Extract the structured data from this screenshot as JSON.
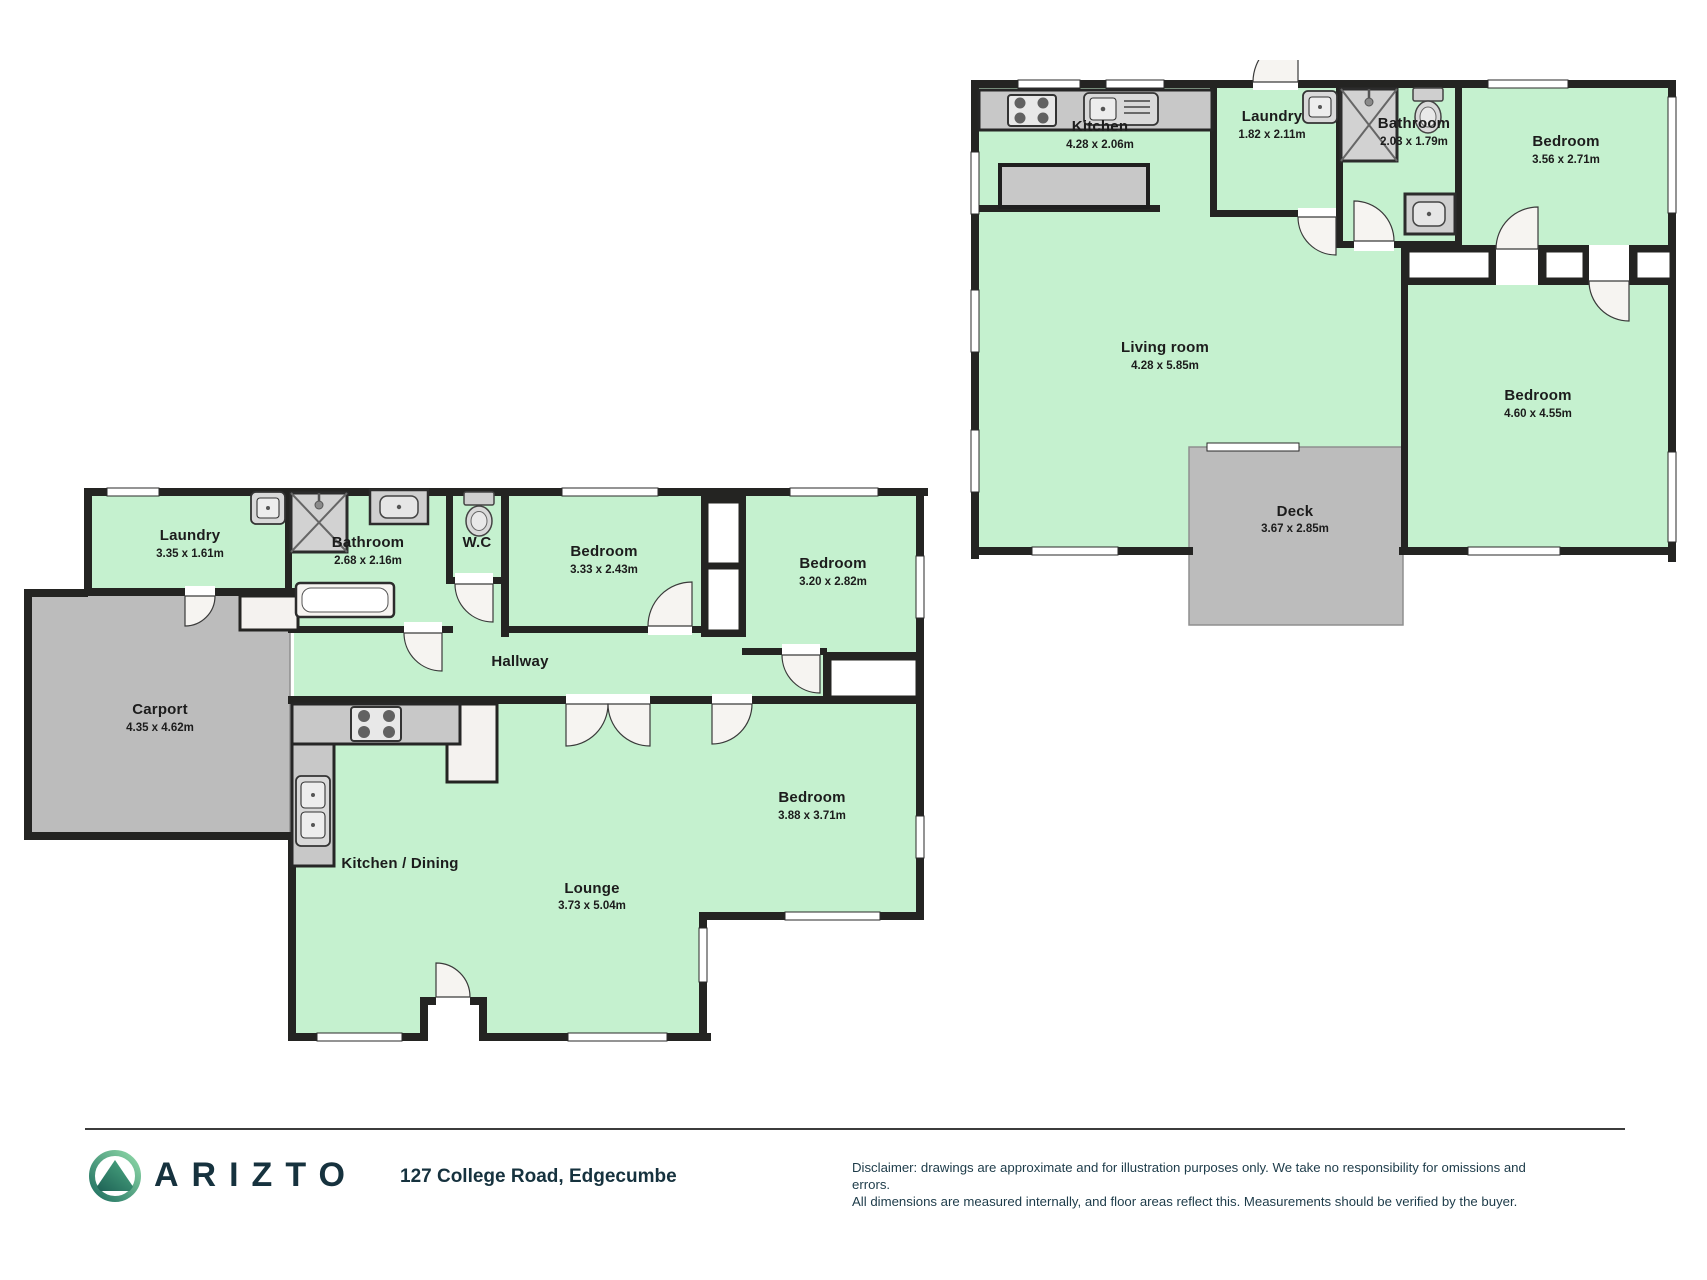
{
  "colors": {
    "floor_green": "#c5f1cf",
    "wall_black": "#242422",
    "outdoor_gray": "#bcbcbc",
    "brand_navy": "#16323e",
    "logo_green_light": "#8fd9a8",
    "logo_teal_dark": "#1e6f60"
  },
  "plans": {
    "upper": {
      "kitchen": {
        "label": "Kitchen",
        "dims": "4.28 x 2.06m"
      },
      "laundry": {
        "label": "Laundry",
        "dims": "1.82 x 2.11m"
      },
      "bathroom": {
        "label": "Bathroom",
        "dims": "2.03 x 1.79m"
      },
      "bedroom1": {
        "label": "Bedroom",
        "dims": "3.56 x 2.71m"
      },
      "living": {
        "label": "Living room",
        "dims": "4.28 x 5.85m"
      },
      "bedroom2": {
        "label": "Bedroom",
        "dims": "4.60 x 4.55m"
      },
      "deck": {
        "label": "Deck",
        "dims": "3.67 x 2.85m"
      }
    },
    "lower": {
      "laundry": {
        "label": "Laundry",
        "dims": "3.35 x 1.61m"
      },
      "bathroom": {
        "label": "Bathroom",
        "dims": "2.68 x 2.16m"
      },
      "wc": {
        "label": "W.C",
        "dims": ""
      },
      "bedroom3": {
        "label": "Bedroom",
        "dims": "3.33 x 2.43m"
      },
      "bedroom4": {
        "label": "Bedroom",
        "dims": "3.20 x 2.82m"
      },
      "hallway": {
        "label": "Hallway",
        "dims": ""
      },
      "carport": {
        "label": "Carport",
        "dims": "4.35 x 4.62m"
      },
      "kitchen_dining": {
        "label": "Kitchen / Dining",
        "dims": ""
      },
      "lounge": {
        "label": "Lounge",
        "dims": "3.73 x 5.04m"
      },
      "bedroom5": {
        "label": "Bedroom",
        "dims": "3.88 x 3.71m"
      }
    }
  },
  "footer": {
    "brand": "ARIZTO",
    "address": "127 College Road, Edgecumbe",
    "disclaimer_line1": "Disclaimer: drawings are approximate and for illustration purposes only. We take no responsibility for omissions and errors.",
    "disclaimer_line2": "All dimensions are measured internally, and floor areas reflect this. Measurements should be verified by the buyer."
  }
}
